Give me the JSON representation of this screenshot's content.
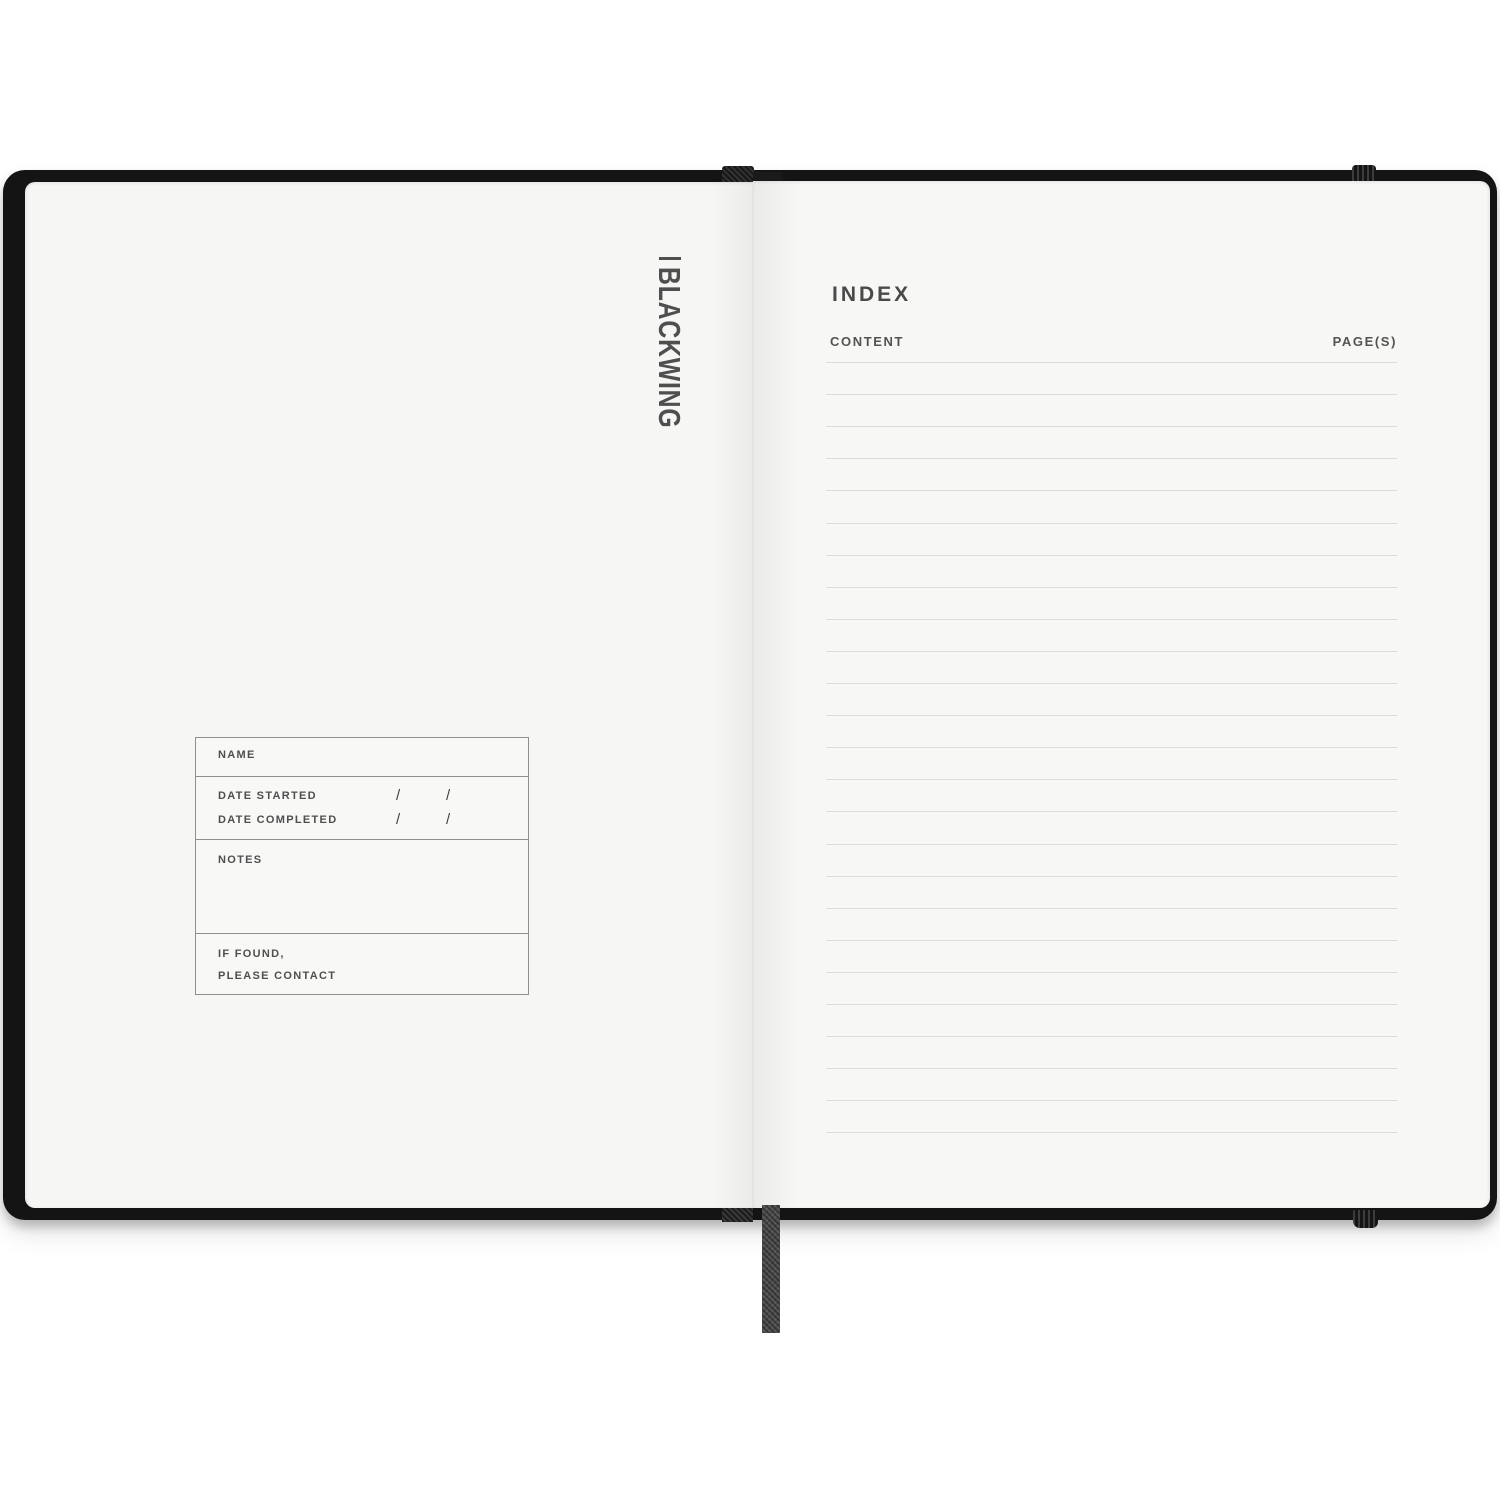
{
  "brand": {
    "name": "BLACKWING"
  },
  "left_page": {
    "logo_text": "BLACKWING",
    "form": {
      "name_label": "NAME",
      "date_started_label": "DATE STARTED",
      "date_completed_label": "DATE COMPLETED",
      "date_slash": "/",
      "notes_label": "NOTES",
      "if_found_line1": "IF FOUND,",
      "if_found_line2": "PLEASE CONTACT"
    }
  },
  "right_page": {
    "title": "INDEX",
    "columns": {
      "content": "CONTENT",
      "pages": "PAGE(S)"
    },
    "ruled_lines": 25,
    "line_spacing_px": 32.1
  },
  "colors": {
    "cover": "#141414",
    "page_left": "#f6f6f5",
    "page_right": "#f7f7f6",
    "ruled_line": "#dcdcda",
    "text": "#4f4f4f",
    "ribbon": "#4e4e4e"
  }
}
